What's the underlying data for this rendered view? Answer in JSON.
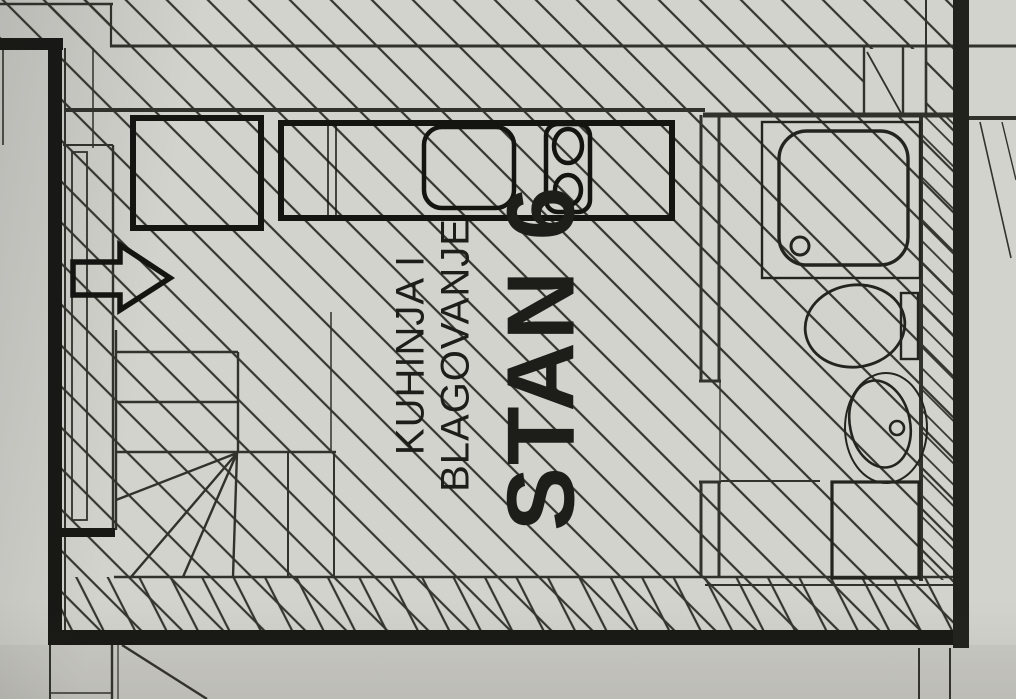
{
  "drawing": {
    "type": "architectural-floor-plan",
    "apartment_label": "STAN 6",
    "room_label_line1": "KUHINJA I",
    "room_label_line2": "BLAGOVANJE",
    "icons": [
      "kitchen-counter-icon",
      "sink-icon",
      "stove-icon",
      "shower-icon",
      "toilet-icon",
      "washbasin-icon",
      "stairs-icon",
      "direction-arrow-icon"
    ],
    "colors": {
      "paper": "#d3d3ce",
      "paper_shadow": "#c7c7c1",
      "thin_line": "#32322d",
      "wall": "#181815",
      "section_band": "#21211e"
    }
  }
}
